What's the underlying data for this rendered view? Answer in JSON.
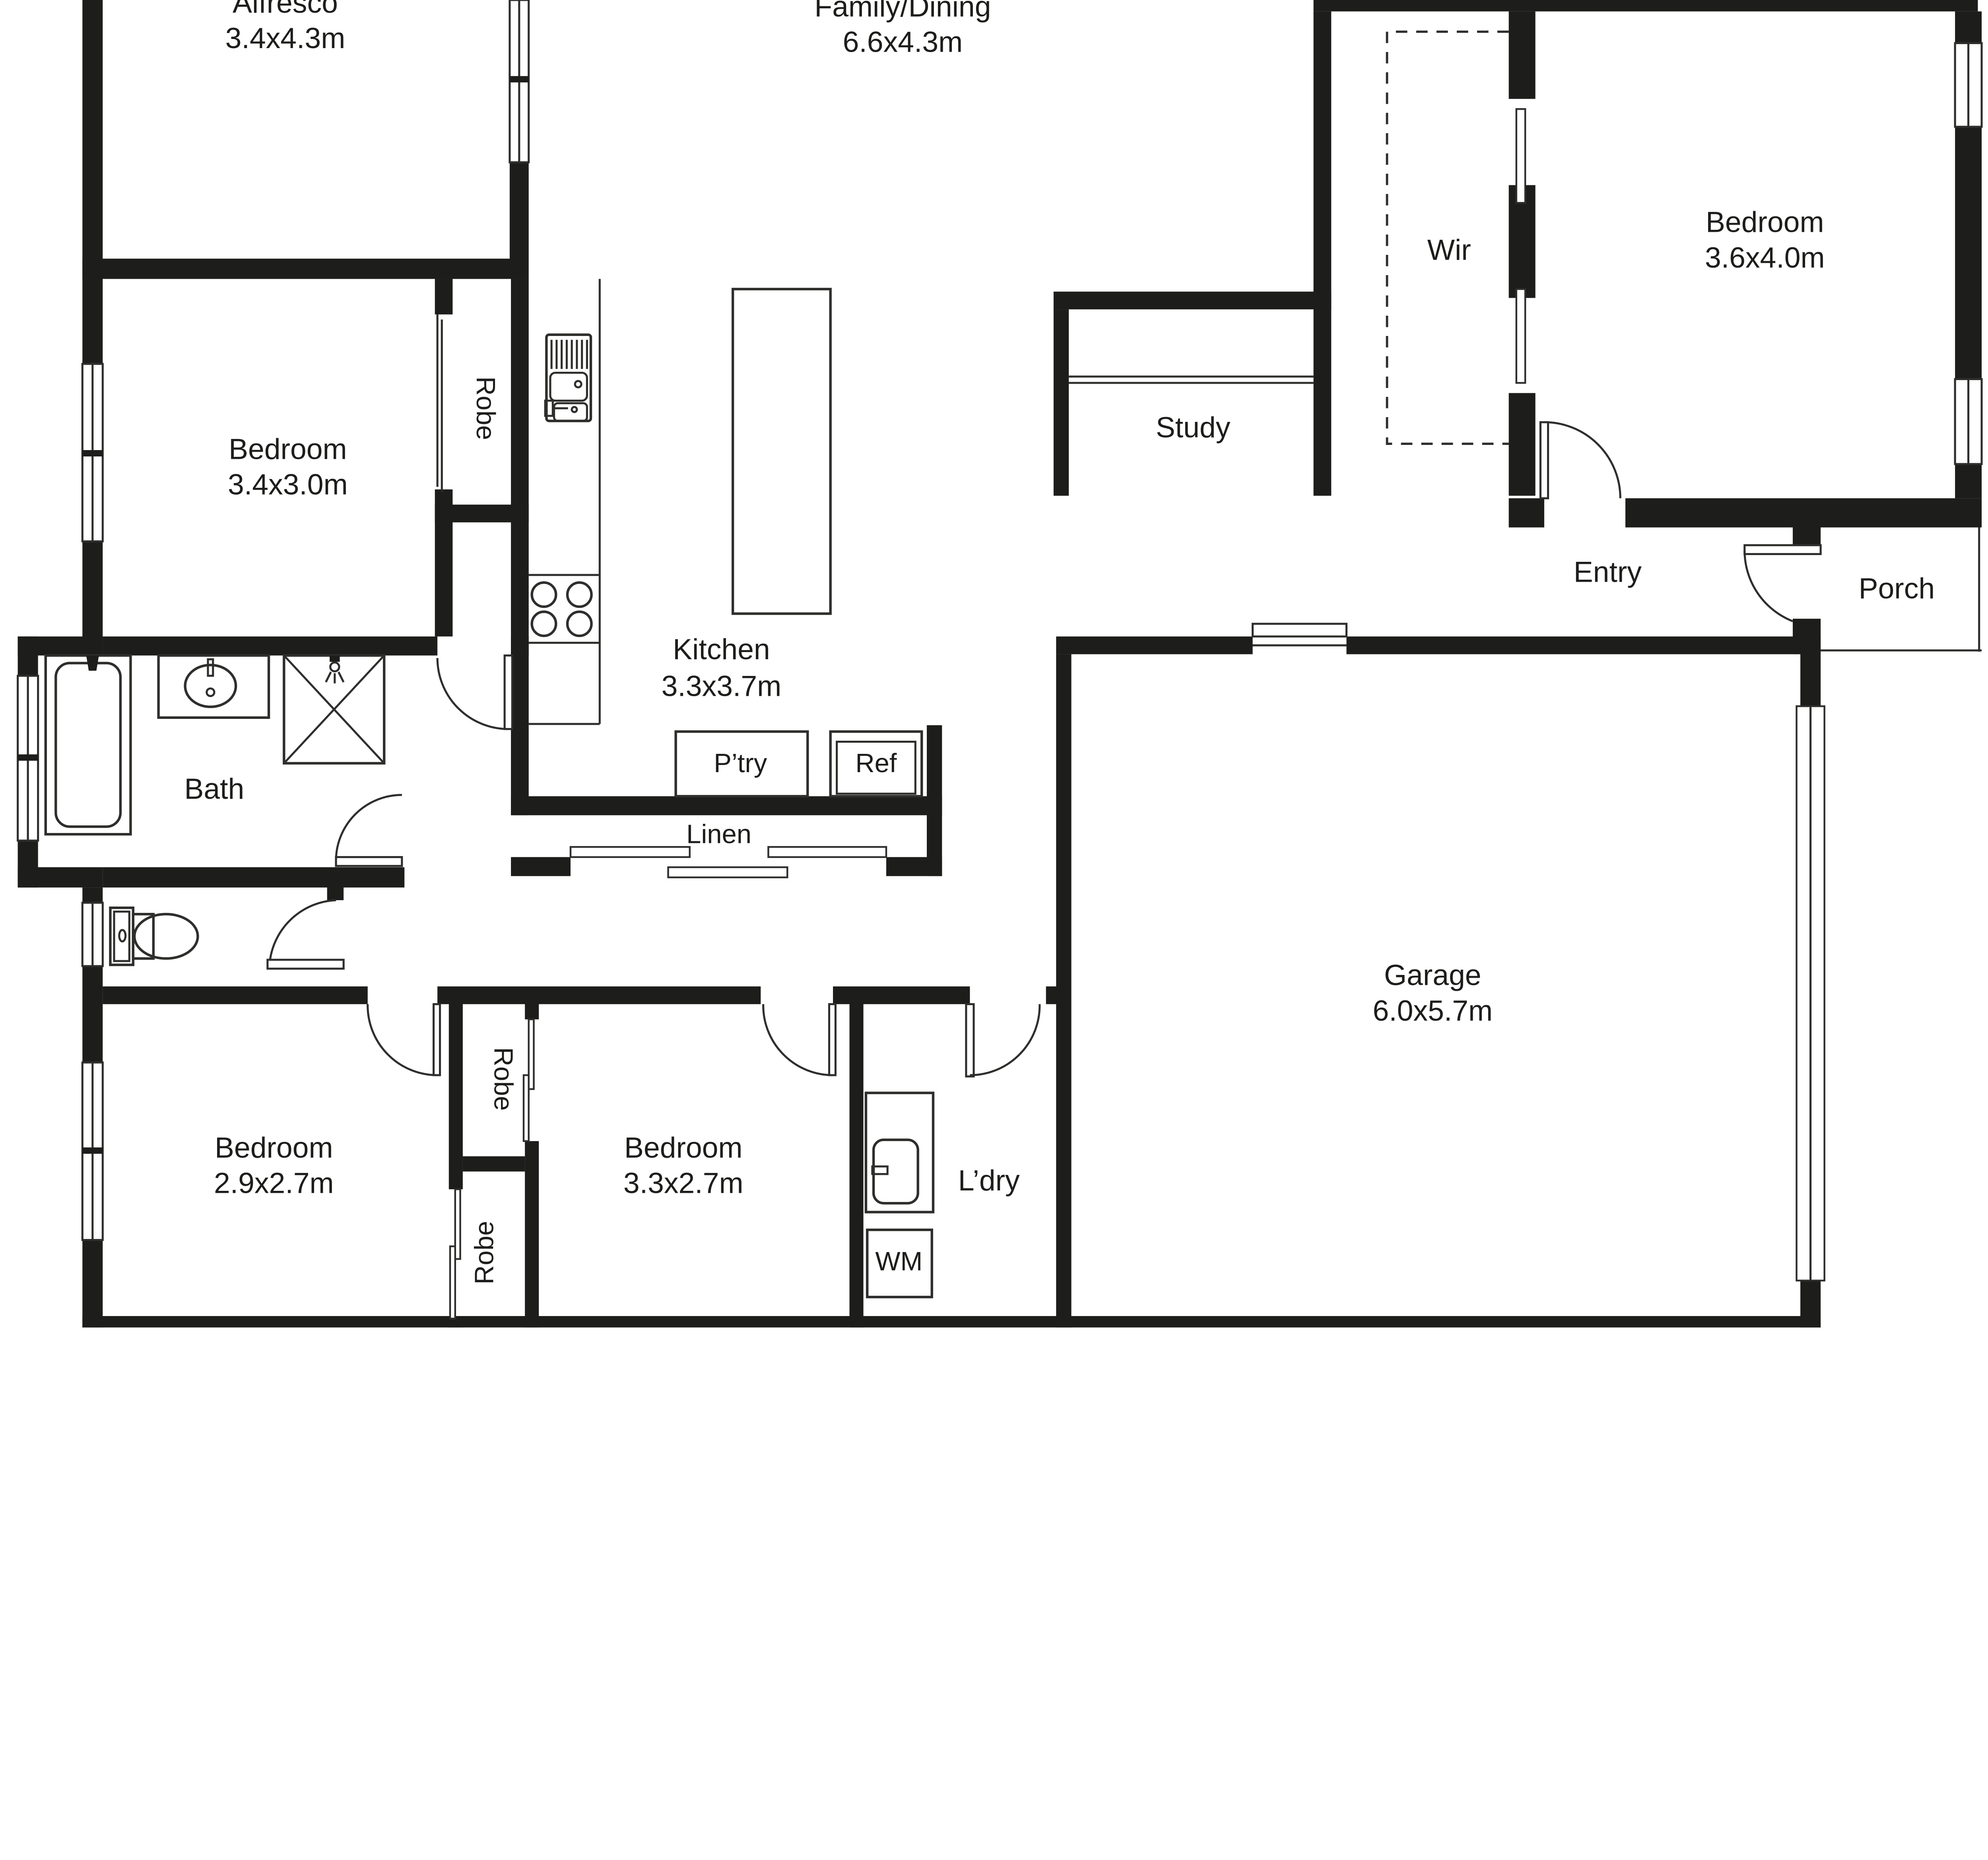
{
  "colors": {
    "wall": "#1d1d1b",
    "line": "#2e2e2c",
    "text": "#1d1d1b",
    "bg": "#ffffff"
  },
  "floorplan": {
    "rooms": {
      "alfresco": {
        "name": "Alfresco",
        "dims": "3.4x4.3m"
      },
      "family_dining": {
        "name": "Family/Dining",
        "dims": "6.6x4.3m"
      },
      "kitchen": {
        "name": "Kitchen",
        "dims": "3.3x3.7m"
      },
      "bedroom_main": {
        "name": "Bedroom",
        "dims": "3.6x4.0m"
      },
      "bedroom_2": {
        "name": "Bedroom",
        "dims": "3.4x3.0m"
      },
      "bedroom_3": {
        "name": "Bedroom",
        "dims": "2.9x2.7m"
      },
      "bedroom_4": {
        "name": "Bedroom",
        "dims": "3.3x2.7m"
      },
      "garage": {
        "name": "Garage",
        "dims": "6.0x5.7m"
      },
      "study": {
        "name": "Study"
      },
      "wir": {
        "name": "Wir"
      },
      "entry": {
        "name": "Entry"
      },
      "porch": {
        "name": "Porch"
      },
      "bath": {
        "name": "Bath"
      },
      "laundry": {
        "name": "L’dry"
      },
      "linen": {
        "name": "Linen"
      },
      "pantry": {
        "name": "P’try"
      },
      "fridge": {
        "name": "Ref"
      },
      "washing_machine": {
        "name": "WM"
      },
      "robe_bed2": {
        "name": "Robe"
      },
      "robe_bed4": {
        "name": "Robe"
      },
      "robe_bed3": {
        "name": "Robe"
      }
    }
  }
}
